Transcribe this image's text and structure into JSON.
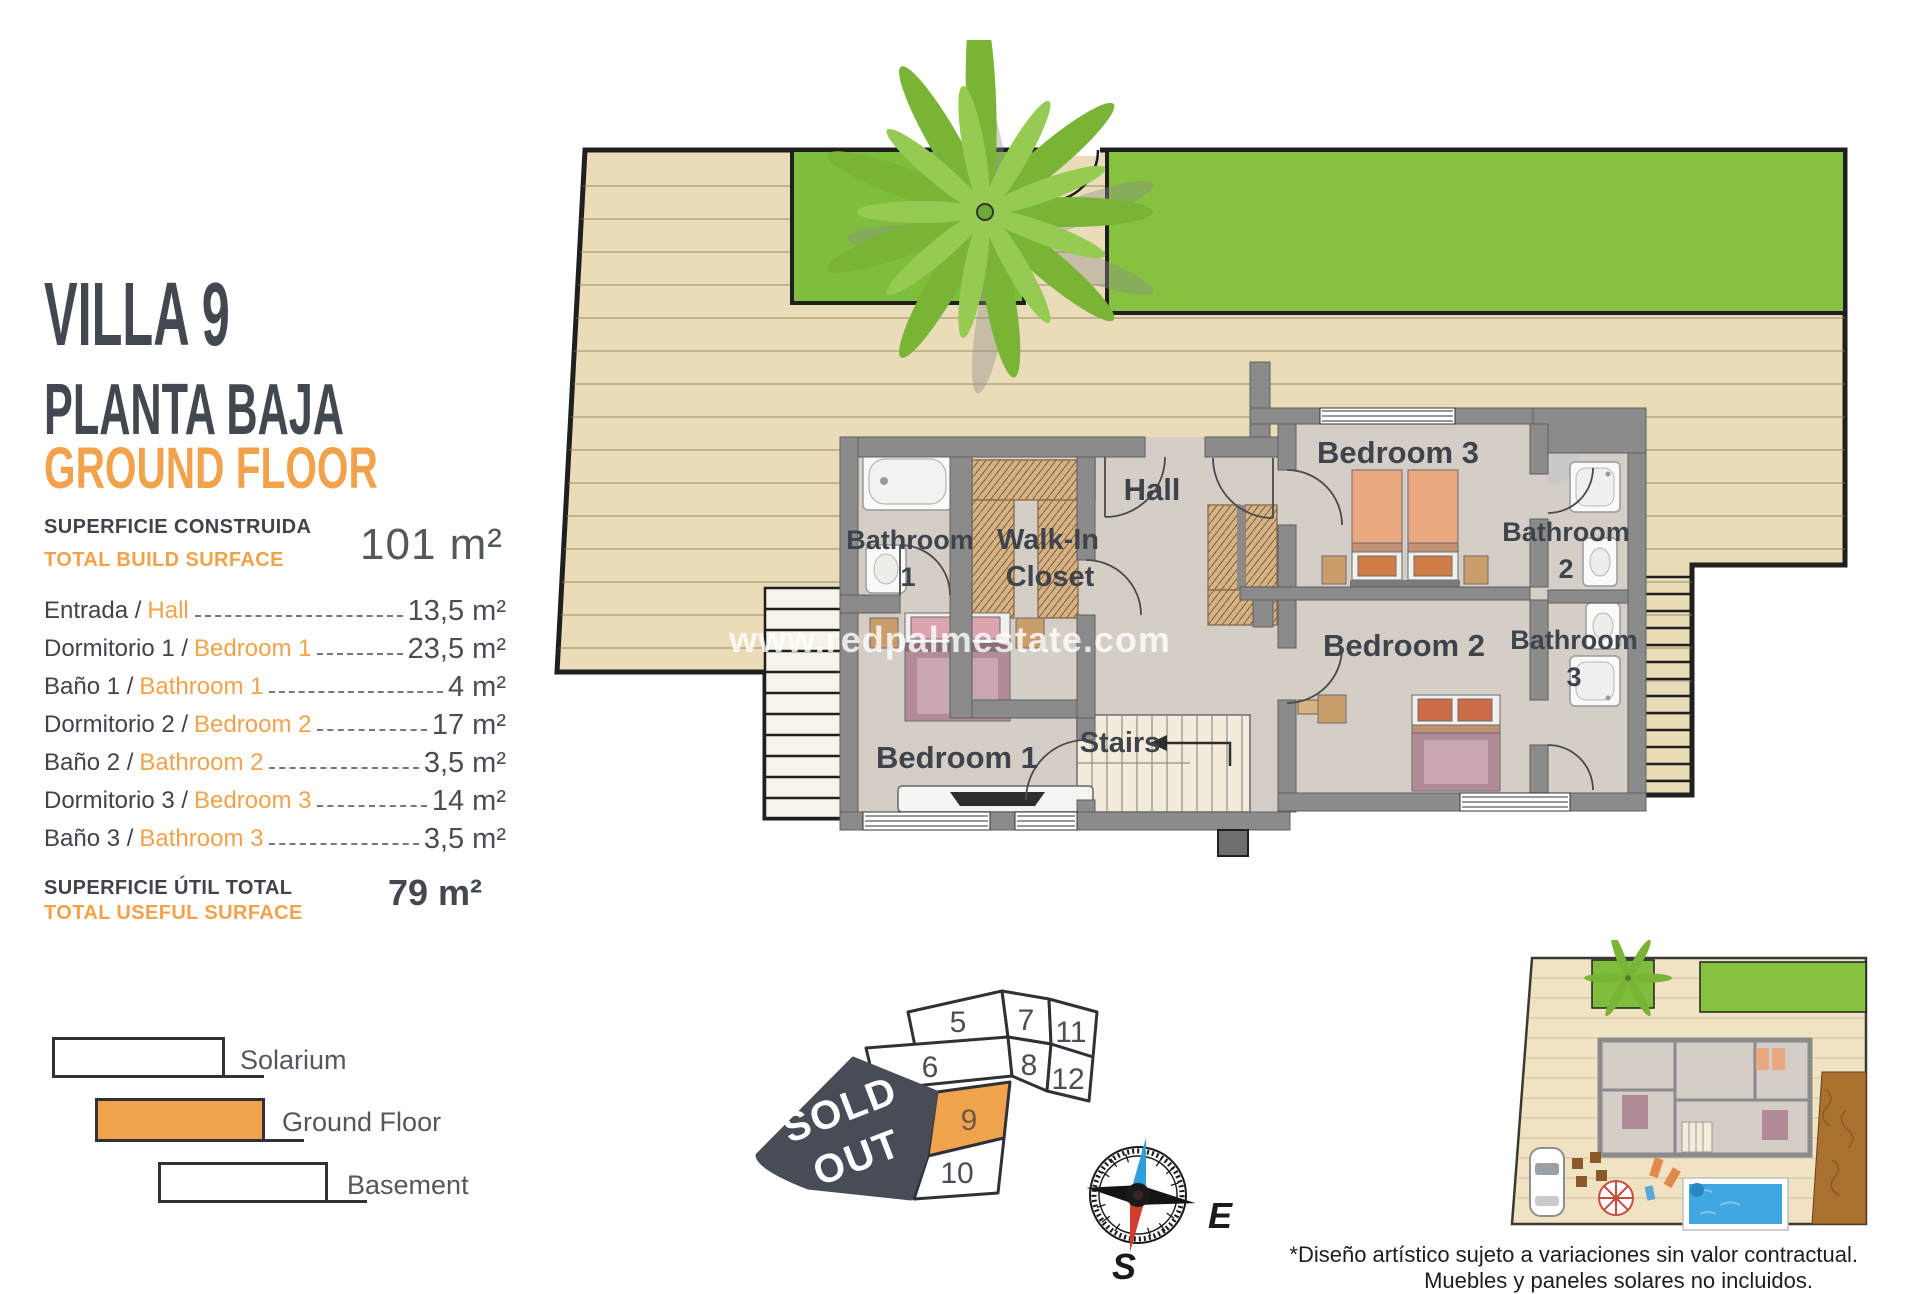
{
  "header": {
    "villa": "VILLA 9",
    "subtitle_es": "PLANTA BAJA",
    "subtitle_en": "GROUND FLOOR"
  },
  "build_surface": {
    "label_es": "SUPERFICIE CONSTRUIDA",
    "label_en": "TOTAL BUILD SURFACE",
    "value": "101 m²"
  },
  "rooms": [
    {
      "es": "Entrada /",
      "en": "Hall",
      "value": "13,5 m²"
    },
    {
      "es": "Dormitorio 1 /",
      "en": "Bedroom 1",
      "value": "23,5 m²"
    },
    {
      "es": "Baño 1 /",
      "en": "Bathroom 1",
      "value": "4 m²"
    },
    {
      "es": "Dormitorio 2 /",
      "en": "Bedroom 2",
      "value": "17 m²"
    },
    {
      "es": "Baño 2 /",
      "en": "Bathroom 2",
      "value": "3,5 m²"
    },
    {
      "es": "Dormitorio 3 /",
      "en": "Bedroom 3",
      "value": "14 m²"
    },
    {
      "es": "Baño 3 /",
      "en": "Bathroom 3",
      "value": "3,5 m²"
    }
  ],
  "useful_surface": {
    "label_es": "SUPERFICIE ÚTIL TOTAL",
    "label_en": "TOTAL USEFUL SURFACE",
    "value": "79 m²"
  },
  "legend": {
    "items": [
      {
        "label": "Solarium",
        "color": "#FFFFFF"
      },
      {
        "label": "Ground Floor",
        "color": "#F0A24D"
      },
      {
        "label": "Basement",
        "color": "#FFFFFF"
      }
    ]
  },
  "floor_plan": {
    "labels": {
      "bathroom1_line1": "Bathroom",
      "bathroom1_line2": "1",
      "wic_line1": "Walk-In",
      "wic_line2": "Closet",
      "hall": "Hall",
      "bedroom3": "Bedroom 3",
      "bathroom2_line1": "Bathroom",
      "bathroom2_line2": "2",
      "bedroom2": "Bedroom 2",
      "bathroom3_line1": "Bathroom",
      "bathroom3_line2": "3",
      "bedroom1": "Bedroom 1",
      "stairs": "Stairs"
    },
    "watermark": "www.redpalmestate.com"
  },
  "site_map": {
    "plots": [
      "5",
      "7",
      "11",
      "6",
      "8",
      "12",
      "9",
      "10"
    ],
    "sold_out_line1": "SOLD",
    "sold_out_line2": "OUT",
    "highlighted_plot": "9",
    "highlight_color": "#F0A24D"
  },
  "compass": {
    "east": "E",
    "south": "S"
  },
  "footer": {
    "line1": "*Diseño artístico sujeto a variaciones sin valor contractual.",
    "line2": "Muebles y paneles solares no incluidos."
  },
  "colors": {
    "accent_orange": "#F2A24B",
    "dark_text": "#43474F",
    "sold_out_bg": "#474C56"
  }
}
